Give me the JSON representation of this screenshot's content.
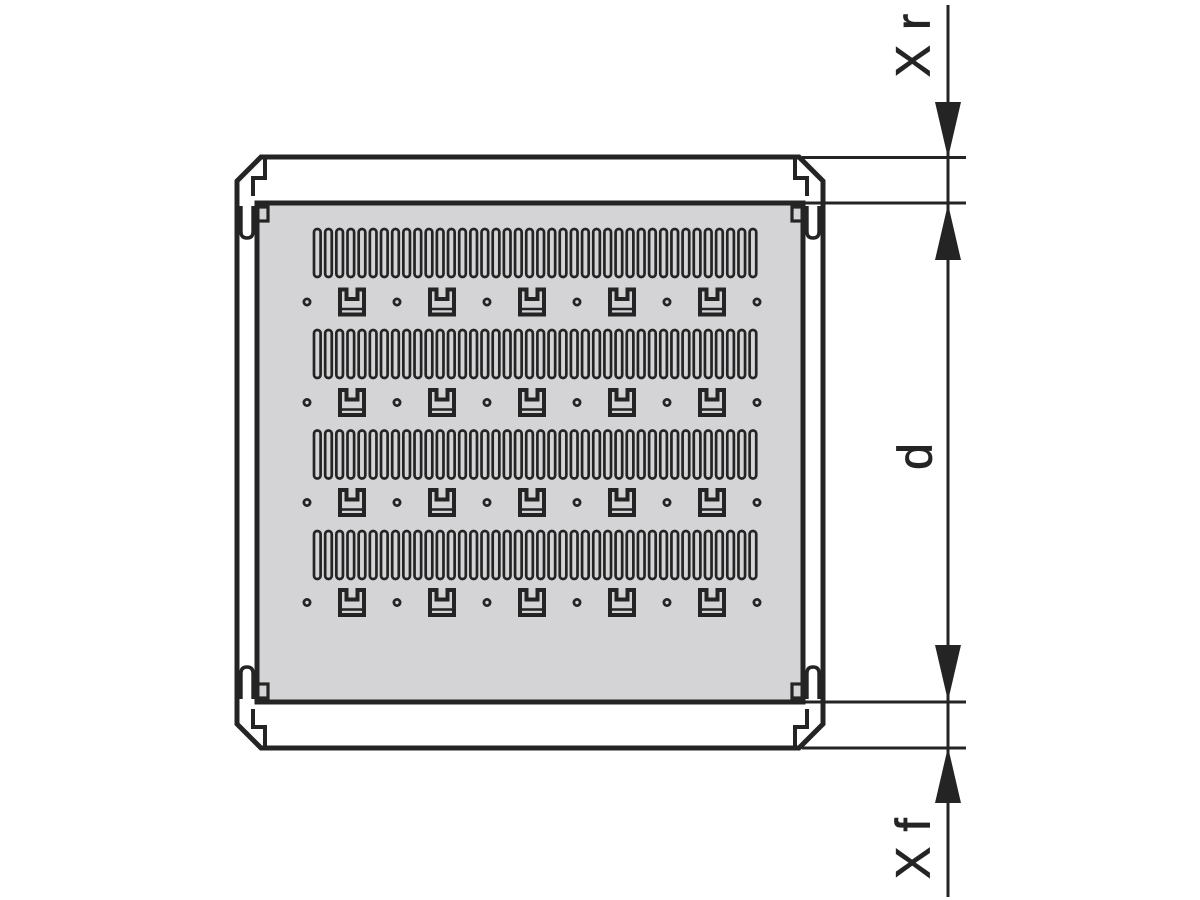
{
  "drawing": {
    "labels": {
      "dim_rear": "X r",
      "dim_depth": "d",
      "dim_front": "X f"
    },
    "colors": {
      "line": "#242424",
      "panel_fill": "#d4d4d6",
      "background": "#ffffff"
    },
    "pattern": {
      "slot_rows": {
        "ys": [
          229,
          330,
          430.5,
          531
        ],
        "x_start": 314,
        "pitch": 11.17,
        "count": 40,
        "slot_width": 6.6,
        "slot_height": 48
      },
      "tie_rows": {
        "cys": [
          302,
          402.5,
          502.5,
          602.5
        ],
        "dot_xs": [
          307,
          397,
          487,
          577,
          667,
          757
        ],
        "dot_radius": 3.1,
        "bracket_cxs": [
          352,
          442,
          532,
          622,
          712
        ],
        "bracket_width": 28,
        "bracket_height": 29
      }
    }
  }
}
